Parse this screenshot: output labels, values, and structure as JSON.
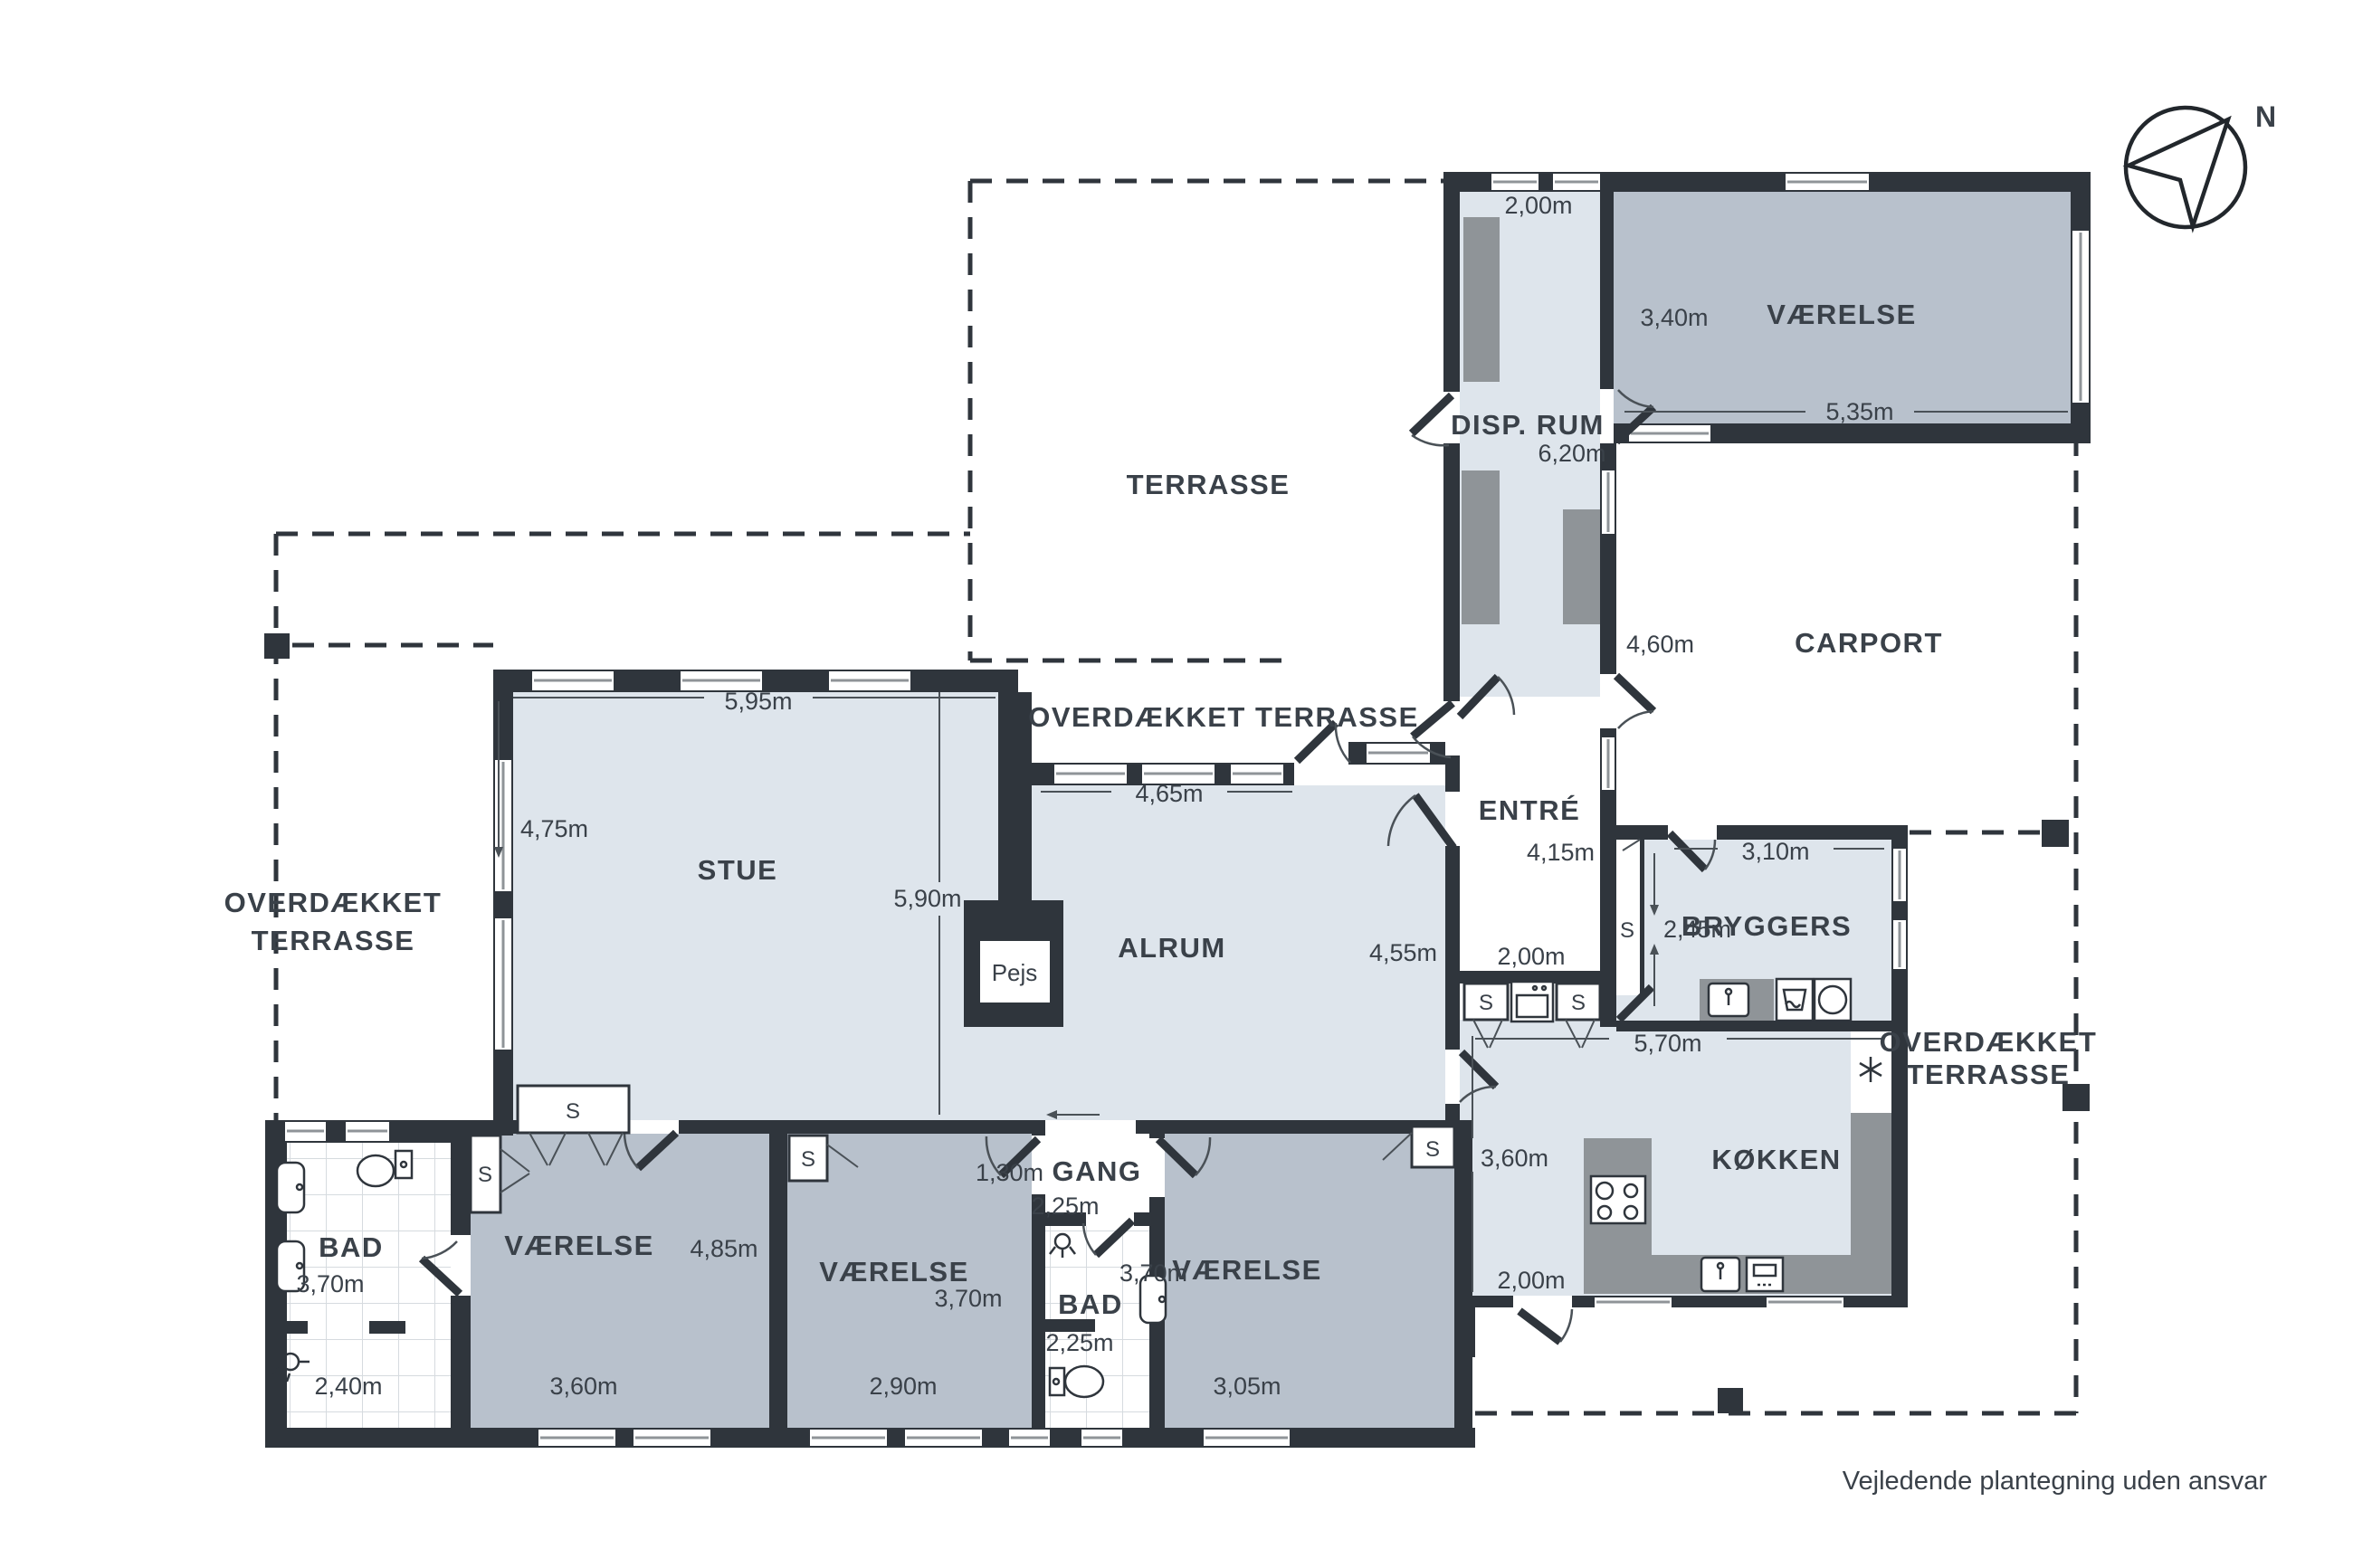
{
  "footer": "Vejledende plantegning uden ansvar",
  "compass": "N",
  "closet": "S",
  "outdoor": {
    "terrasse": "TERRASSE",
    "carport": "CARPORT",
    "covered_top": "OVERDÆKKET TERRASSE",
    "covered_l1": "OVERDÆKKET",
    "covered_l2": "TERRASSE"
  },
  "rooms": {
    "disp": {
      "name": "DISP. RUM",
      "w": "2,00m",
      "l": "6,20m"
    },
    "vne": {
      "name": "VÆRELSE",
      "d": "3,40m",
      "w": "5,35m"
    },
    "entre": {
      "name": "ENTRÉ",
      "l": "4,15m",
      "w": "2,00m",
      "hall": "4,60m"
    },
    "bryggers": {
      "name": "BRYGGERS",
      "w": "3,10m",
      "d": "2,45m"
    },
    "stue": {
      "name": "STUE",
      "w": "5,95m",
      "d": "4,75m",
      "mid": "5,90m"
    },
    "alrum": {
      "name": "ALRUM",
      "w": "4,65m",
      "d": "4,55m"
    },
    "koekken": {
      "name": "KØKKEN",
      "w": "5,70m",
      "d": "3,60m",
      "door": "2,00m"
    },
    "pejs": {
      "name": "Pejs"
    },
    "badw": {
      "name": "BAD",
      "d": "3,70m",
      "w": "2,40m"
    },
    "v1": {
      "name": "VÆRELSE",
      "d": "4,85m",
      "w": "3,60m"
    },
    "v2": {
      "name": "VÆRELSE",
      "d": "3,70m",
      "w": "2,90m"
    },
    "gang": {
      "name": "GANG",
      "w": "1,30m",
      "d": "2,25m"
    },
    "bads": {
      "name": "BAD",
      "w": "2,25m"
    },
    "v3": {
      "name": "VÆRELSE",
      "d": "3,70m",
      "w": "3,05m"
    }
  }
}
